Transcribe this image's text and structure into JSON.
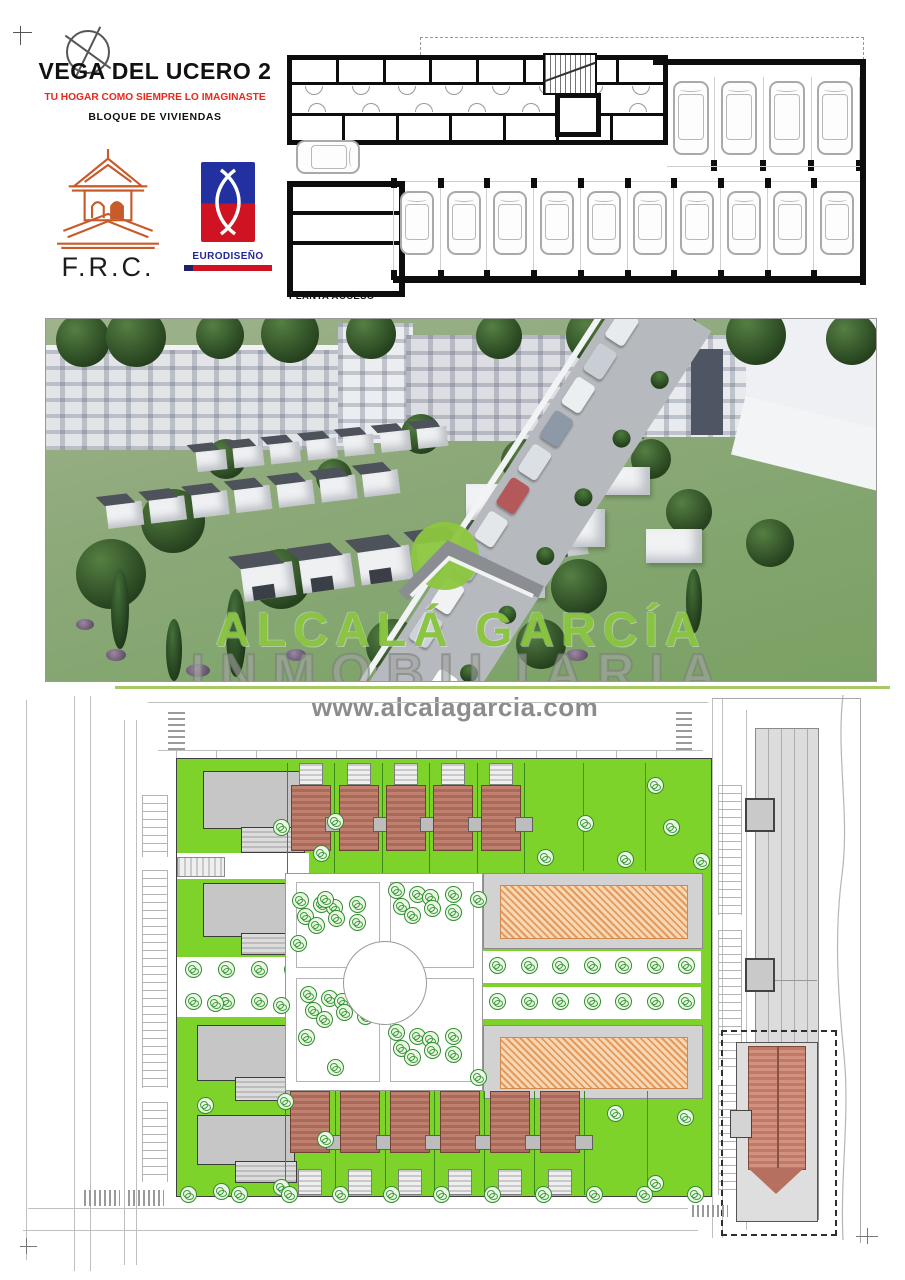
{
  "header": {
    "title": "VEGA DEL UCERO 2",
    "tagline": "TU HOGAR COMO SIEMPRE LO IMAGINASTE",
    "subtitle": "BLOQUE DE VIVIENDAS"
  },
  "logos": {
    "frc_label": "F.R.C.",
    "eurodiseno_label": "EURODISEÑO"
  },
  "floorplan": {
    "caption": "PLANTA ACCESO"
  },
  "render_watermark": {
    "brand": "ALCALÁ GARCÍA",
    "descriptor": "INMOBILIARIA"
  },
  "footer": {
    "website": "www.alcalagarcia.com"
  },
  "icons": {
    "north_compass": "circle-with-cross",
    "frc_pavilion": "orange-line-art-pavilion",
    "eurodiseno_mark": "blue-red-emblem",
    "watermark_roof": "gray-chevron-roof",
    "tree": "outlined-green-circle",
    "car": "top-view-rounded-rect"
  },
  "colors": {
    "brand_green": "#8dc63f",
    "tagline_red": "#e8291c",
    "site_green": "#7ed32b",
    "roof_terracotta": "#bf7b69",
    "hatch_orange": "#e59a5d",
    "frc_orange": "#c75b2a",
    "eurodiseno_blue": "#2230a0",
    "eurodiseno_red": "#cf1322"
  }
}
